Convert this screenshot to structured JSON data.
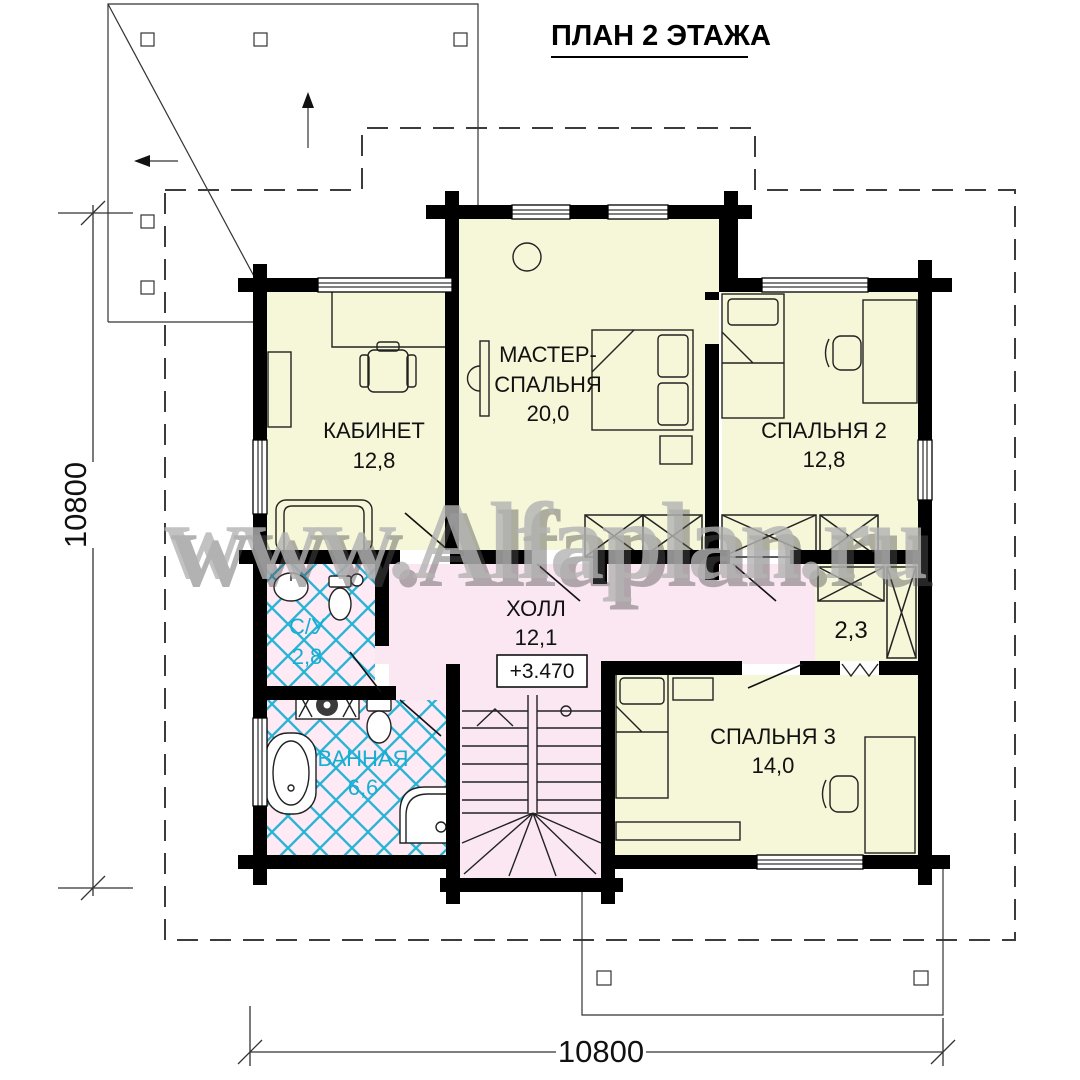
{
  "title": "ПЛАН 2 ЭТАЖА",
  "watermark": "www.Alfaplan.ru",
  "rooms": {
    "kabinet": {
      "label": "КАБИНЕТ",
      "area": "12,8"
    },
    "master": {
      "label_line1": "МАСТЕР-",
      "label_line2": "СПАЛЬНЯ",
      "area": "20,0"
    },
    "bedroom2": {
      "label": "СПАЛЬНЯ 2",
      "area": "12,8"
    },
    "bedroom3": {
      "label": "СПАЛЬНЯ 3",
      "area": "14,0"
    },
    "hall": {
      "label": "ХОЛЛ",
      "area": "12,1"
    },
    "wc": {
      "label": "С/У",
      "area": "2,8"
    },
    "bathroom": {
      "label": "ВАННАЯ",
      "area": "6,6"
    },
    "closet": {
      "area": "2,3"
    }
  },
  "elevation_mark": "+3.470",
  "dimensions": {
    "left": "10800",
    "bottom": "10800"
  },
  "colors": {
    "room_fill": "#f6f6d9",
    "wet_room_fill": "#fdeaf4",
    "hall_fill": "#fbe7f2",
    "tile_line": "#29b4d4",
    "wet_label": "#16aed2",
    "wall": "#000000",
    "watermark_gray": "#b3b3b3"
  }
}
